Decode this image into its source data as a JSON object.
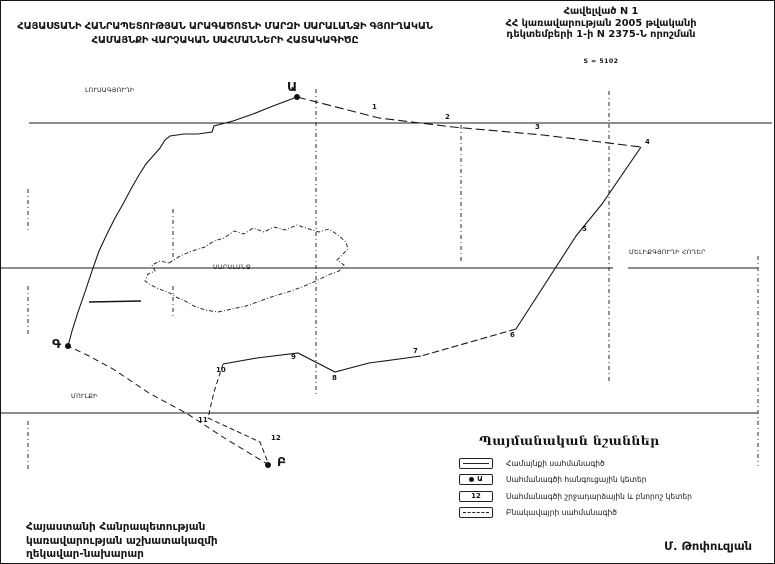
{
  "page": {
    "title_line1": "ՀԱՅԱՍՏԱՆԻ ՀԱՆՐԱՊԵՏՈՒԹՅԱՆ ԱՐԱԳԱԾՈՏՆԻ ՄԱՐԶԻ ՍԱՐԱԼԱՆՋԻ ԳՅՈՒՂԱԿԱՆ",
    "title_line2": "ՀԱՄԱՅՆՔԻ ՎԱՐՉԱԿԱՆ ՍԱՀՄԱՆՆԵՐԻ ՀԱՏԱԿԱԳԻԾԸ"
  },
  "annex": {
    "line1": "Հավելված N 1",
    "line2": "ՀՀ կառավարության 2005 թվականի",
    "line3": "դեկտեմբերի 1-ի N 2375-Ն որոշման",
    "scale_note": "S = 5102"
  },
  "map": {
    "community_name": "ՍԱՐԱԼԱՆՋ",
    "region_labels": [
      {
        "text": "ԼՈՒՍԱԳՅՈՒՂԻ",
        "x": 84,
        "y": 86
      },
      {
        "text": "ՄԵԼԻՔԳՅՈՒՂԻ ՀՈՂԵՐ",
        "x": 628,
        "y": 248
      },
      {
        "text": "ՍԱՐԱԼԱՆՋ",
        "x": 212,
        "y": 263
      },
      {
        "text": "ՄՈՒԼՔԻ",
        "x": 70,
        "y": 392
      }
    ],
    "points": [
      {
        "label": "Ա",
        "type": "node",
        "x": 286,
        "y": 78,
        "dot": {
          "x": 296,
          "y": 96
        }
      },
      {
        "label": "Բ",
        "type": "node",
        "x": 276,
        "y": 453,
        "dot": {
          "x": 267,
          "y": 464
        }
      },
      {
        "label": "Գ",
        "type": "node",
        "x": 51,
        "y": 335,
        "dot": {
          "x": 67,
          "y": 345
        }
      },
      {
        "label": "1",
        "type": "turn",
        "x": 371,
        "y": 102
      },
      {
        "label": "2",
        "type": "turn",
        "x": 444,
        "y": 112
      },
      {
        "label": "3",
        "type": "turn",
        "x": 534,
        "y": 122
      },
      {
        "label": "4",
        "type": "turn",
        "x": 644,
        "y": 137
      },
      {
        "label": "5",
        "type": "turn",
        "x": 581,
        "y": 224
      },
      {
        "label": "6",
        "type": "turn",
        "x": 509,
        "y": 330
      },
      {
        "label": "7",
        "type": "turn",
        "x": 412,
        "y": 346
      },
      {
        "label": "8",
        "type": "turn",
        "x": 331,
        "y": 373
      },
      {
        "label": "9",
        "type": "turn",
        "x": 290,
        "y": 352
      },
      {
        "label": "10",
        "type": "turn",
        "x": 215,
        "y": 365
      },
      {
        "label": "11",
        "type": "turn",
        "x": 197,
        "y": 415
      },
      {
        "label": "12",
        "type": "turn",
        "x": 270,
        "y": 433
      }
    ]
  },
  "legend": {
    "title": "Պայմանական նշաններ",
    "items": [
      {
        "symbol": "line",
        "label": "Համայնքի սահմանագիծ"
      },
      {
        "symbol": "node",
        "symbol_text": "Ա",
        "label": "Սահմանագծի հանգուցային կետեր"
      },
      {
        "symbol": "number",
        "symbol_text": "12",
        "label": "Սահմանագծի շրջադարձային և բնորոշ կետեր"
      },
      {
        "symbol": "dash",
        "label": "Բնակավայրի սահմանագիծ"
      }
    ]
  },
  "footer": {
    "left_line1": "Հայաստանի Հանրապետության",
    "left_line2": "կառավարության աշխատակազմի",
    "left_line3": "ղեկավար-նախարար",
    "signature": "Մ. Թոփուզյան"
  }
}
